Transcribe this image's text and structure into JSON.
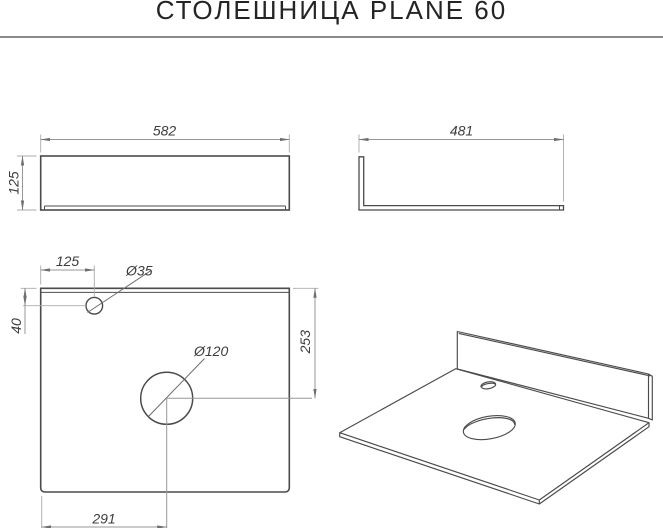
{
  "title": "СТОЛЕШНИЦА PLANE 60",
  "front_view": {
    "width": "582",
    "height": "125"
  },
  "side_view": {
    "depth": "481"
  },
  "plan_view": {
    "faucet_offset_x": "125",
    "faucet_offset_y": "40",
    "faucet_diameter": "Ø35",
    "drain_diameter": "Ø120",
    "drain_offset_y": "253",
    "drain_offset_x": "291"
  },
  "colors": {
    "background": "#ffffff",
    "outline": "#4b4b4b",
    "dimension_line": "#979797",
    "dimension_text": "#3c3c3c",
    "title_text": "#242424",
    "separator": "#8a8a8a"
  }
}
